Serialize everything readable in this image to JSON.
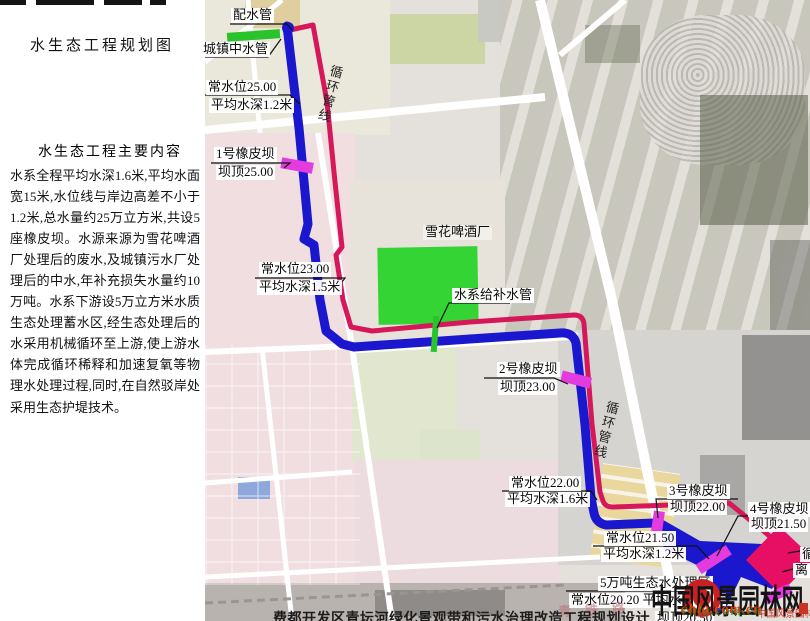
{
  "panel": {
    "title": "水生态工程规划图",
    "section_title": "水生态工程主要内容",
    "body": "水系全程平均水深1.6米,平均水面宽15米,水位线与岸边高差不小于1.2米,总水量约25万立方米,共设5座橡皮坝。水源来源为雪花啤酒厂处理后的废水,及城镇污水厂处理后的中水,年补充损失水量约10万吨。水系下游设5万立方米水质生态处理蓄水区,经生态处理后的水采用机械循环至上游,使上游水体完成循环稀释和加速复氧等物理水处理过程,同时,在自然驳岸处采用生态护堤技术。"
  },
  "map": {
    "labels": {
      "distribution_pipe": "配水管",
      "town_reclaimed_pipe": "城镇中水管",
      "level25_l1": "常水位25.00",
      "level25_l2": "平均水深1.2米",
      "dam1_l1": "1号橡皮坝",
      "dam1_l2": "坝顶25.00",
      "level23_l1": "常水位23.00",
      "level23_l2": "平均水深1.5米",
      "factory": "雪花啤酒厂",
      "supply_pipe": "水系给补水管",
      "dam2_l1": "2号橡皮坝",
      "dam2_l2": "坝顶23.00",
      "circulation_line": "循环管线",
      "level22_l1": "常水位22.00",
      "level22_l2": "平均水深1.6米",
      "dam3_l1": "3号橡皮坝",
      "dam3_l2": "坝顶22.00",
      "level215_l1": "常水位21.50",
      "level215_l2": "平均水深1.2米",
      "dam4_l1": "4号橡皮坝",
      "dam4_l2": "坝顶21.50",
      "treatment_area": "5万吨生态水处理区",
      "level202": "常水位20.20  平均水深2.2米",
      "dam5_crest": "坝顶20.50",
      "pump_cut_1": "循",
      "pump_cut_2": "离",
      "railway": "青铁路"
    }
  },
  "watermark": {
    "site_name": "中国风景园林网",
    "url": "chla.com.cn",
    "calligraphy": "中国风景园林网"
  },
  "caption": "费都开发区青坛河绿化景观带和污水治理改造工程规划设计",
  "colors": {
    "water_line": "#1a17cf",
    "circulation_line": "#d6175a",
    "dam_marker": "#e43bdf",
    "pump_diamond": "#e60f63",
    "green_pipe": "#2bc32b",
    "factory_green": "#35d435"
  }
}
